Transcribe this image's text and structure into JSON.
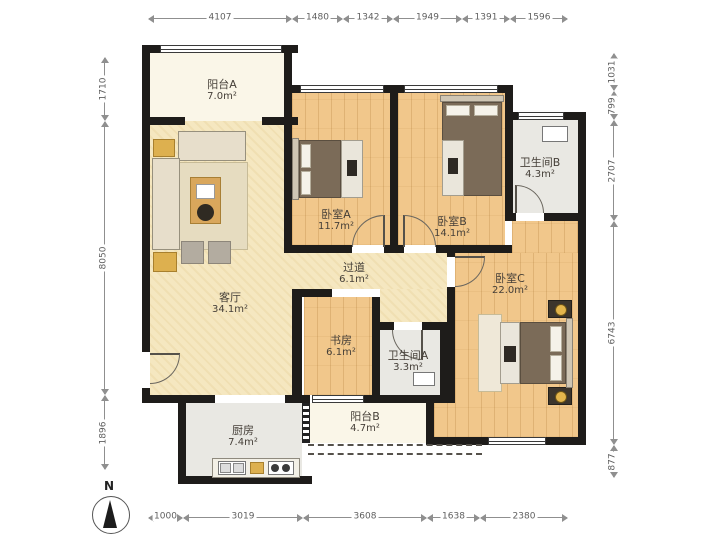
{
  "plan": {
    "type": "apartment-floor-plan",
    "north_label": "N",
    "rooms": {
      "balcony_a": {
        "name": "阳台A",
        "area": "7.0m²"
      },
      "living": {
        "name": "客厅",
        "area": "34.1m²"
      },
      "bedroom_a": {
        "name": "卧室A",
        "area": "11.7m²"
      },
      "bedroom_b": {
        "name": "卧室B",
        "area": "14.1m²"
      },
      "bathroom_b": {
        "name": "卫生间B",
        "area": "4.3m²"
      },
      "bedroom_c": {
        "name": "卧室C",
        "area": "22.0m²"
      },
      "hallway": {
        "name": "过道",
        "area": "6.1m²"
      },
      "study": {
        "name": "书房",
        "area": "6.1m²"
      },
      "bathroom_a": {
        "name": "卫生间A",
        "area": "3.3m²"
      },
      "kitchen": {
        "name": "厨房",
        "area": "7.4m²"
      },
      "balcony_b": {
        "name": "阳台B",
        "area": "4.7m²"
      }
    },
    "dimensions_mm": {
      "top": [
        "4107",
        "1480",
        "1342",
        "1949",
        "1391",
        "1596"
      ],
      "bottom": [
        "1000",
        "3019",
        "3608",
        "1638",
        "2380"
      ],
      "left": [
        "1710",
        "8050",
        "1896"
      ],
      "right": [
        "1031",
        "799",
        "2707",
        "6743",
        "877"
      ]
    },
    "colors": {
      "wall": "#1e1c1a",
      "wood_floor": "#f1c78b",
      "living_floor": "#f5e7c0",
      "tile_floor": "#e9e8e3",
      "balcony_floor": "#faf6e8",
      "accent_yellow": "#ddb04f"
    }
  }
}
